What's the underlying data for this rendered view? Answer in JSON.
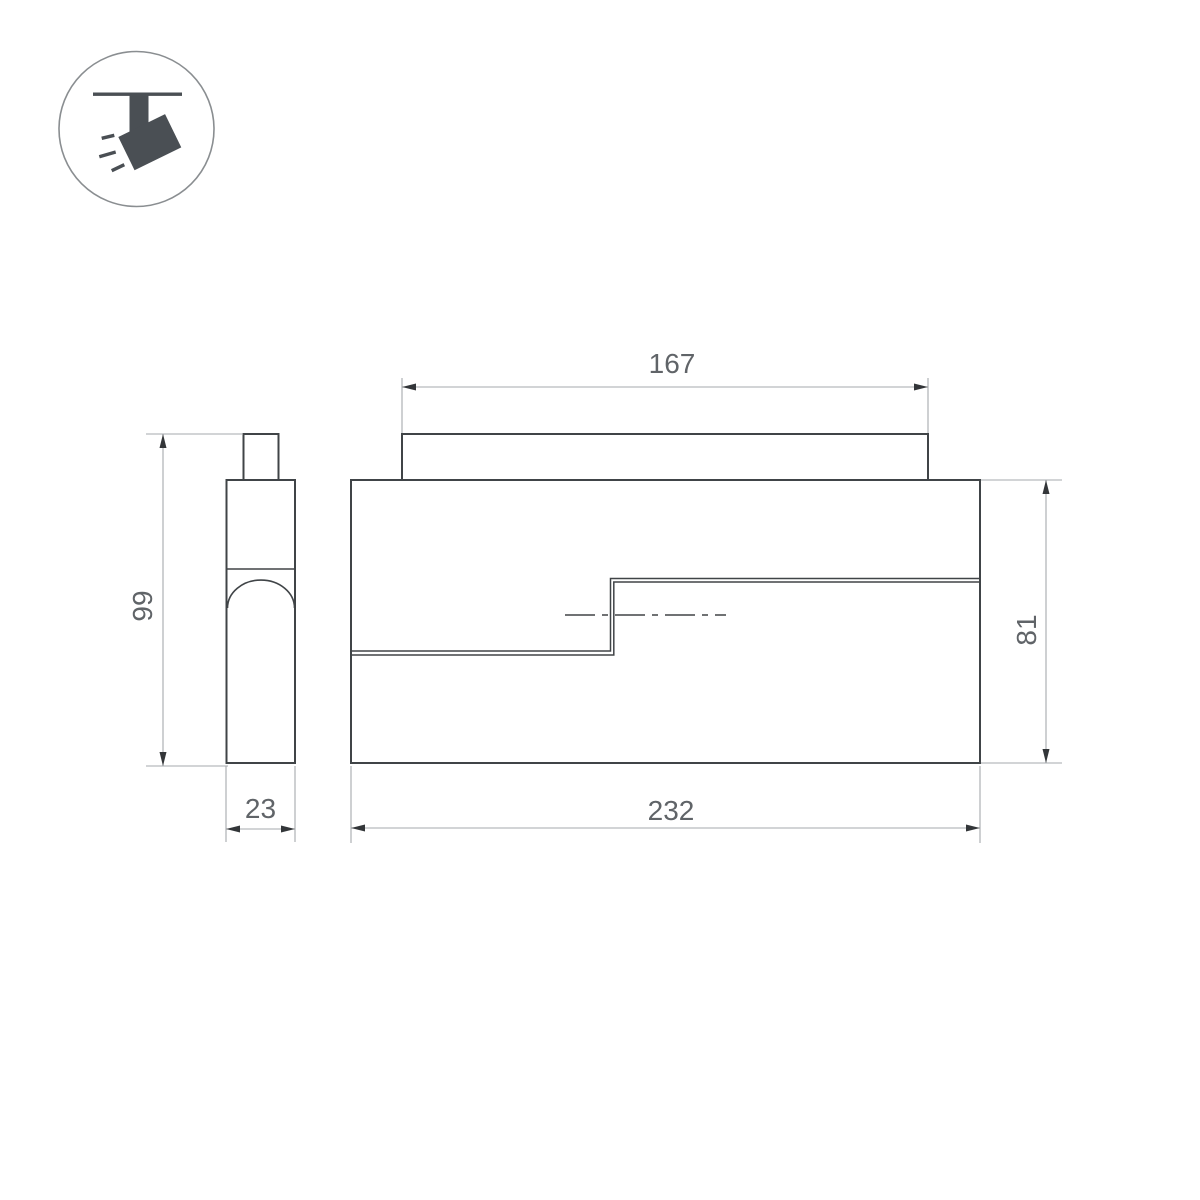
{
  "icon": {
    "name": "track-spotlight-icon",
    "depicts": "ceiling-track spotlight tilted with light rays"
  },
  "views": [
    {
      "id": "side-view"
    },
    {
      "id": "front-view"
    }
  ],
  "dimensions": [
    {
      "id": "adapter-length",
      "label": "167",
      "view": "front-view",
      "axis": "horizontal"
    },
    {
      "id": "body-length",
      "label": "232",
      "view": "front-view",
      "axis": "horizontal"
    },
    {
      "id": "body-height",
      "label": "81",
      "view": "front-view",
      "axis": "vertical"
    },
    {
      "id": "overall-height",
      "label": "99",
      "view": "side-view",
      "axis": "vertical"
    },
    {
      "id": "body-depth",
      "label": "23",
      "view": "side-view",
      "axis": "horizontal"
    }
  ],
  "colors": {
    "background": "#ffffff",
    "object_line": "#404447",
    "dimension_line": "#a6aaad",
    "arrowhead": "#333639",
    "dimension_text": "#606468",
    "icon_glyph": "#4a4f54",
    "icon_circle_stroke": "#8a8e91"
  }
}
